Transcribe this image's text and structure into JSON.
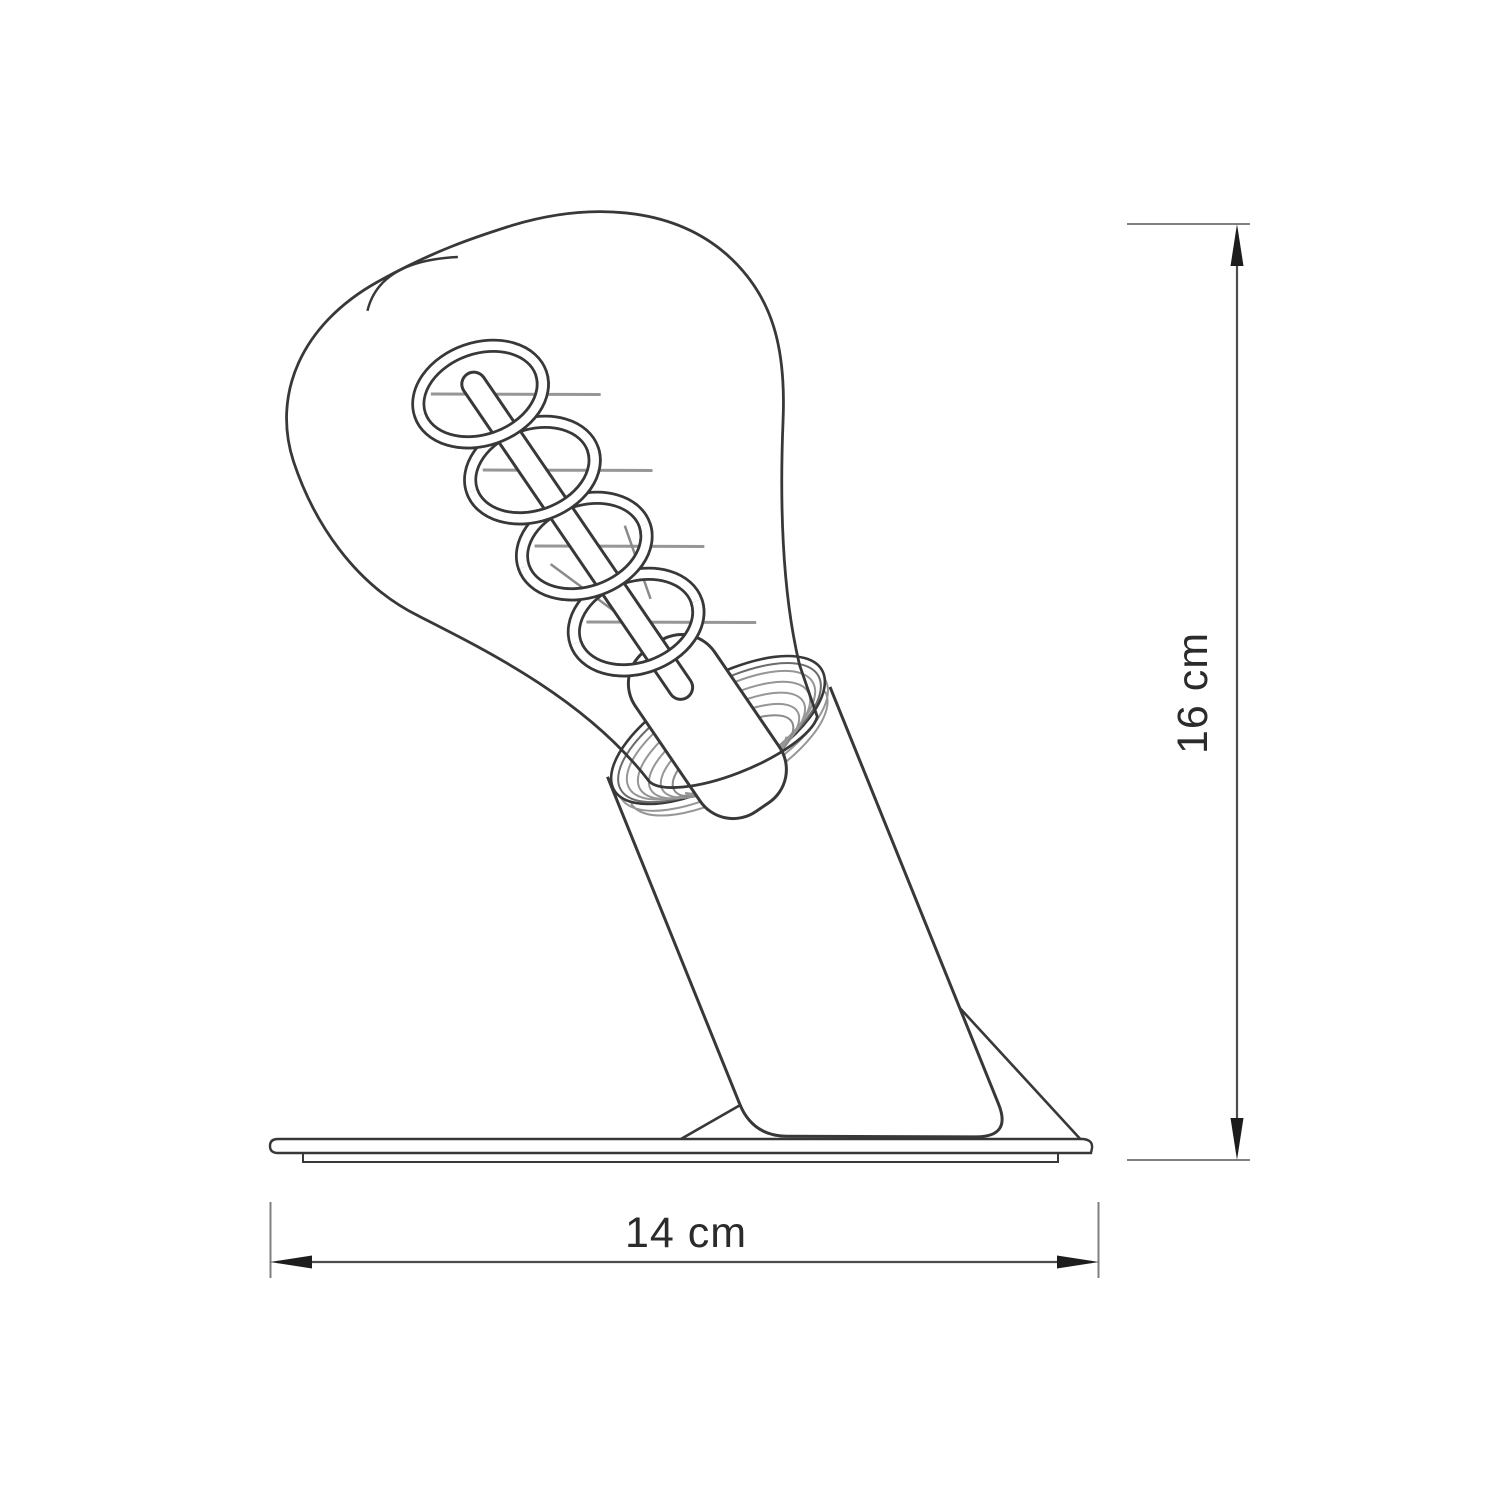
{
  "diagram": {
    "type": "technical-dimension-drawing",
    "subject": "table lamp with tilted cylindrical holder and spiral-filament Edison bulb on a flat base plate",
    "style": "monochrome line art",
    "colors": {
      "background": "#ffffff",
      "outline": "#383838",
      "light_line": "#969696",
      "dimension_line": "#4d4d4d",
      "arrow_fill": "#1d1d1d",
      "text": "#2b2b2b"
    },
    "dimensions": {
      "width": {
        "label": "14 cm",
        "value": 14,
        "unit": "cm",
        "orientation": "horizontal"
      },
      "height": {
        "label": "16 cm",
        "value": 16,
        "unit": "cm",
        "orientation": "vertical"
      }
    }
  }
}
